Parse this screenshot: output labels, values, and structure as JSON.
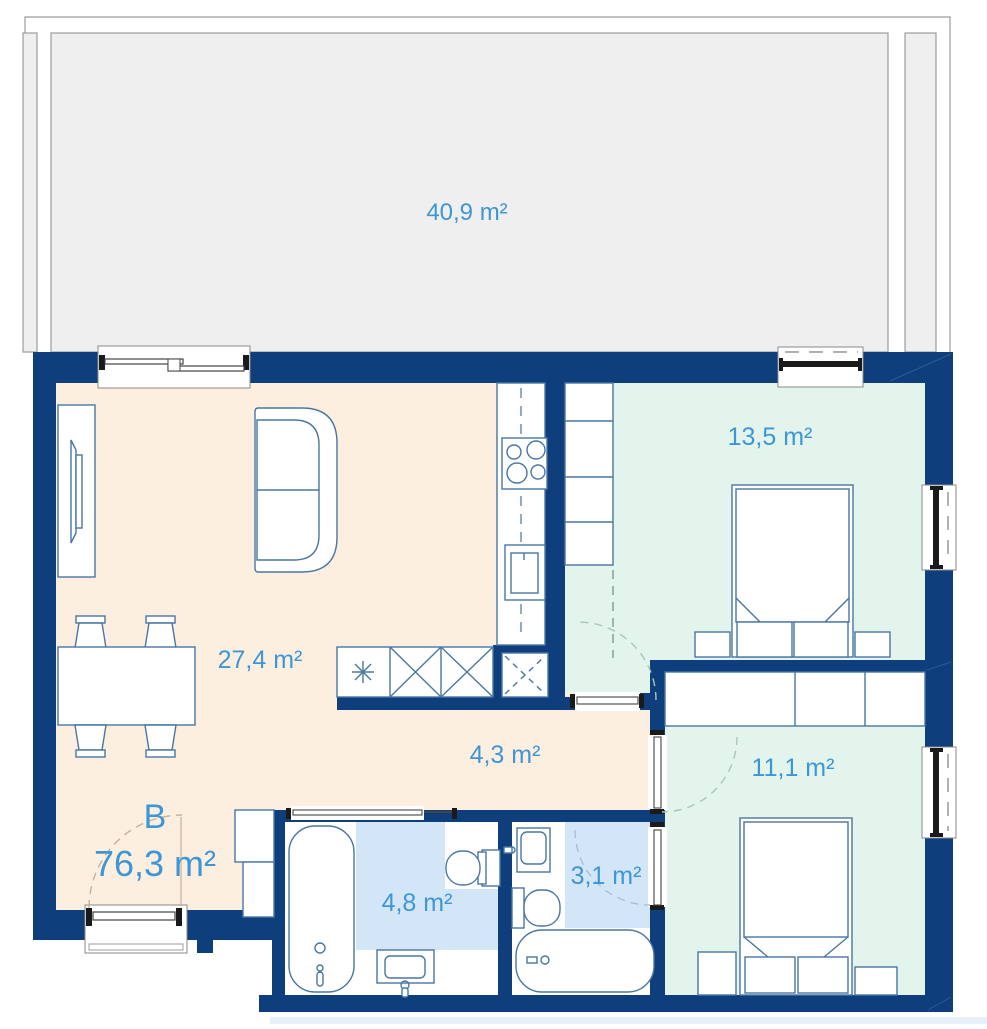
{
  "unit": {
    "name": "B",
    "area": "76,3 m²"
  },
  "rooms": {
    "terrace": {
      "label": "40,9 m²"
    },
    "living": {
      "label": "27,4 m²"
    },
    "bedroom1": {
      "label": "13,5 m²"
    },
    "bedroom2": {
      "label": "11,1 m²"
    },
    "hallway": {
      "label": "4,3 m²"
    },
    "bathroom": {
      "label": "4,8 m²"
    },
    "ensuite": {
      "label": "3,1 m²"
    }
  },
  "fixtures": [
    "sofa",
    "tv-sideboard",
    "dining-table",
    "chairs",
    "kitchen-counter",
    "stove",
    "kitchen-sink",
    "base-cabinets",
    "double-bed",
    "nightstand",
    "wardrobe",
    "bathtub",
    "toilet",
    "washbasin",
    "entrance-door",
    "sliding-door",
    "window",
    "terrace-door"
  ],
  "colors": {
    "wall": "#0e3e7b",
    "floor-living": "#fcefe0",
    "floor-bedroom": "#e2f4eb",
    "floor-bath": "#d3e6f7",
    "terrace": "#efefef",
    "terrace-border": "#9c9c9c",
    "label": "#3e96d6",
    "furn": "#4a76a3",
    "dark": "#1a1a1a"
  }
}
